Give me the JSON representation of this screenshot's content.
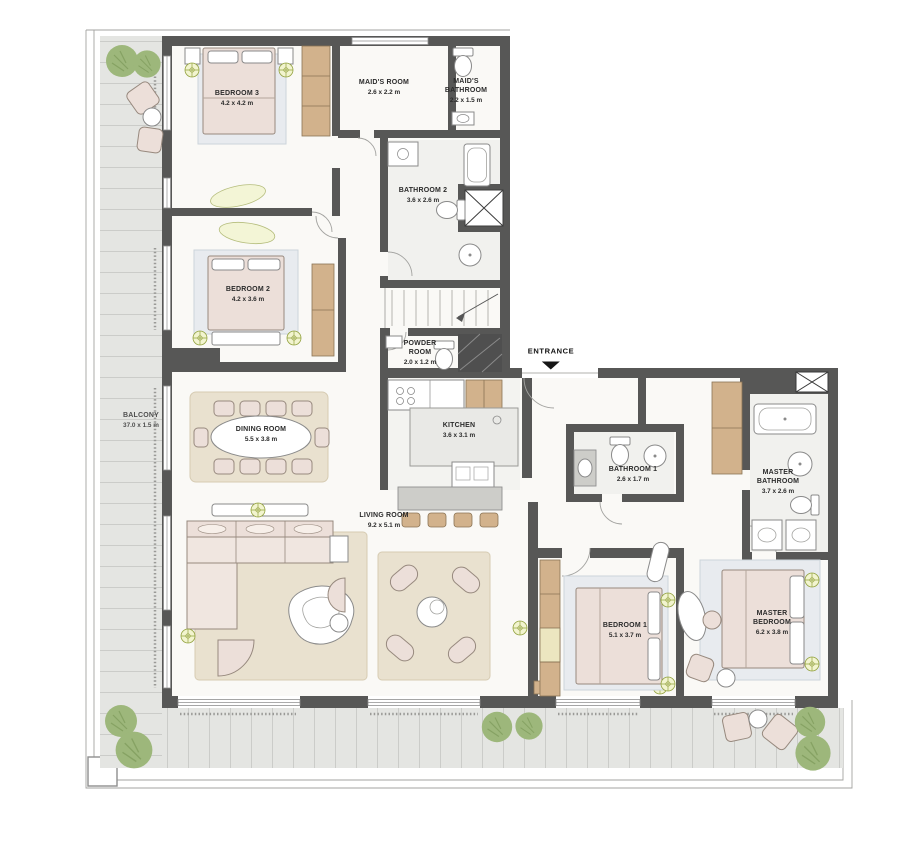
{
  "rooms": {
    "bedroom_3": {
      "name": "BEDROOM 3",
      "dims": "4.2 x 4.2 m"
    },
    "maids_room": {
      "name": "MAID'S ROOM",
      "dims": "2.6 x 2.2 m"
    },
    "maids_bathroom": {
      "name": "MAID'S BATHROOM",
      "dims": "2.2 x 1.5 m"
    },
    "bathroom_2": {
      "name": "BATHROOM 2",
      "dims": "3.6 x 2.6 m"
    },
    "bedroom_2": {
      "name": "BEDROOM 2",
      "dims": "4.2 x 3.6 m"
    },
    "powder_room": {
      "name": "POWDER ROOM",
      "dims": "2.0 x 1.2 m"
    },
    "balcony": {
      "name": "BALCONY",
      "dims": "37.0 x 1.5 m"
    },
    "dining_room": {
      "name": "DINING ROOM",
      "dims": "5.5 x 3.8 m"
    },
    "kitchen": {
      "name": "KITCHEN",
      "dims": "3.6 x 3.1 m"
    },
    "living_room": {
      "name": "LIVING ROOM",
      "dims": "9.2 x 5.1 m"
    },
    "bathroom_1": {
      "name": "BATHROOM 1",
      "dims": "2.6 x 1.7 m"
    },
    "master_bathroom": {
      "name": "MASTER BATHROOM",
      "dims": "3.7 x 2.6 m"
    },
    "bedroom_1": {
      "name": "BEDROOM 1",
      "dims": "5.1 x 3.7 m"
    },
    "master_bedroom": {
      "name": "MASTER BEDROOM",
      "dims": "6.2 x 3.8 m"
    }
  },
  "entrance": {
    "label": "ENTRANCE"
  },
  "colors": {
    "wall": "#575756",
    "wood": "#d2b28c",
    "tile": "#e4e5e2",
    "floor": "#faf9f6",
    "tree": "#9db77b",
    "furniture": "#ecdfd9",
    "accent_light": "#93a23f",
    "label_text": "#2b2b2b"
  }
}
